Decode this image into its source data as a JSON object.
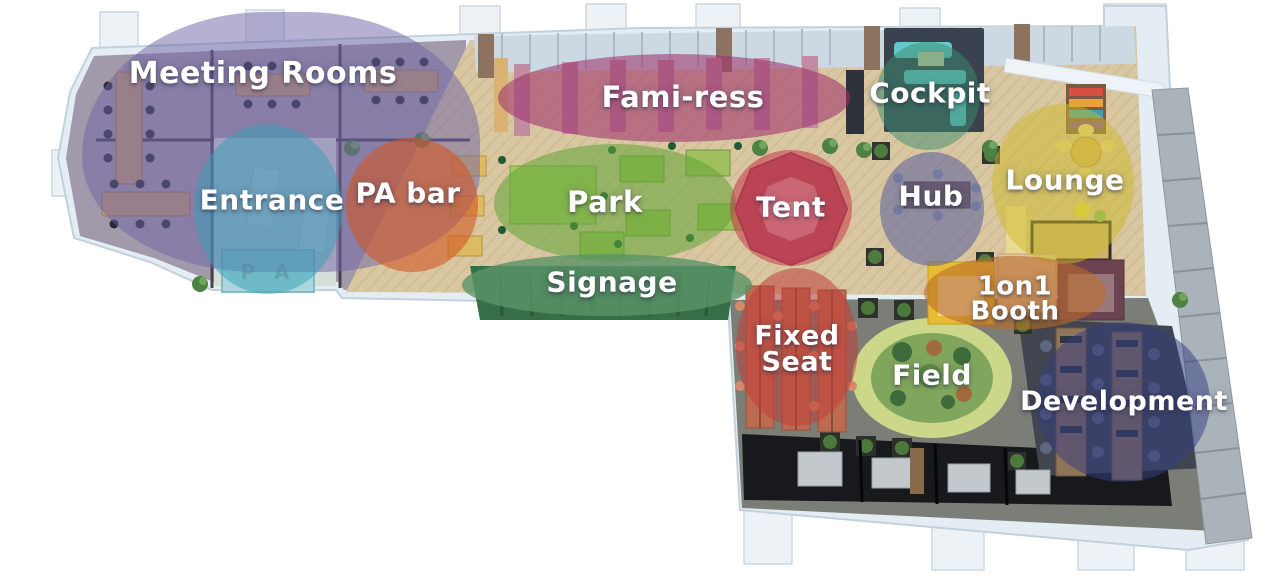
{
  "floorplan": {
    "entrance_mat_text": "P A",
    "palette": {
      "wall": "#e4edf3",
      "wood_floor": "#d9c7a1",
      "meeting_floor": "#a29aab",
      "lower_wing_floor": "#7b7e76",
      "dark_rooms": "#17191d",
      "field_outer": "#cdd789",
      "field_inner": "#80a65d",
      "right_wall": "#aab3ba"
    },
    "zones": [
      {
        "id": "meeting-rooms",
        "label": "Meeting Rooms",
        "x": 82,
        "y": 12,
        "w": 398,
        "h": 260,
        "radius": "48% 46% 42% 46% / 58% 52% 40% 46%",
        "color": "rgba(110,98,165,0.50)",
        "dx": -18,
        "dy": -68,
        "font": 30
      },
      {
        "id": "fami-ress",
        "label": "Fami-ress",
        "x": 498,
        "y": 54,
        "w": 352,
        "h": 88,
        "radius": "50%",
        "color": "rgba(158,52,110,0.58)",
        "dx": 9,
        "dy": 0,
        "font": 29
      },
      {
        "id": "cockpit",
        "label": "Cockpit",
        "x": 876,
        "y": 42,
        "w": 104,
        "h": 108,
        "radius": "50%",
        "color": "rgba(60,140,108,0.50)",
        "dx": 2,
        "dy": -2,
        "font": 28
      },
      {
        "id": "entrance",
        "label": "Entrance",
        "x": 194,
        "y": 124,
        "w": 148,
        "h": 170,
        "radius": "50%",
        "color": "rgba(60,160,182,0.52)",
        "dx": 4,
        "dy": -8,
        "font": 28
      },
      {
        "id": "pa-bar",
        "label": "PA bar",
        "x": 346,
        "y": 138,
        "w": 132,
        "h": 134,
        "radius": "50%",
        "color": "rgba(210,86,36,0.60)",
        "dx": -4,
        "dy": -11,
        "font": 28
      },
      {
        "id": "park",
        "label": "Park",
        "x": 494,
        "y": 144,
        "w": 242,
        "h": 118,
        "radius": "50%",
        "color": "rgba(96,164,54,0.55)",
        "dx": -10,
        "dy": 0,
        "font": 29
      },
      {
        "id": "tent",
        "label": "Tent",
        "x": 730,
        "y": 150,
        "w": 122,
        "h": 116,
        "radius": "50%",
        "color": "rgba(198,54,74,0.55)",
        "dx": 0,
        "dy": 0,
        "font": 28
      },
      {
        "id": "hub",
        "label": "Hub",
        "x": 880,
        "y": 152,
        "w": 104,
        "h": 114,
        "radius": "50%",
        "color": "rgba(86,92,156,0.55)",
        "dx": -1,
        "dy": -12,
        "font": 28
      },
      {
        "id": "lounge",
        "label": "Lounge",
        "x": 992,
        "y": 104,
        "w": 142,
        "h": 160,
        "radius": "50%",
        "color": "rgba(206,186,42,0.50)",
        "dx": 2,
        "dy": -3,
        "font": 28
      },
      {
        "id": "signage",
        "label": "Signage",
        "x": 462,
        "y": 254,
        "w": 290,
        "h": 62,
        "radius": "50%",
        "color": "rgba(90,148,102,0.80)",
        "dx": 5,
        "dy": -2,
        "font": 28
      },
      {
        "id": "fixed-seat",
        "label": "Fixed Seat",
        "lines": [
          "Fixed",
          "Seat"
        ],
        "x": 736,
        "y": 268,
        "w": 122,
        "h": 158,
        "radius": "50%",
        "color": "rgba(192,62,58,0.55)",
        "dx": 0,
        "dy": 2,
        "font": 27
      },
      {
        "id": "1on1-booth",
        "label": "1on1 Booth",
        "lines": [
          "1on1",
          "Booth"
        ],
        "x": 924,
        "y": 256,
        "w": 182,
        "h": 74,
        "radius": "50%",
        "color": "rgba(186,108,44,0.60)",
        "dx": 0,
        "dy": 6,
        "font": 26
      },
      {
        "id": "field",
        "label": "Field",
        "x": 862,
        "y": 318,
        "w": 140,
        "h": 116,
        "radius": "50%",
        "color": "rgba(0,0,0,0)",
        "dx": 0,
        "dy": 0,
        "font": 28
      },
      {
        "id": "development",
        "label": "Development",
        "x": 1036,
        "y": 322,
        "w": 174,
        "h": 160,
        "radius": "50%",
        "color": "rgba(54,62,130,0.52)",
        "dx": 1,
        "dy": 0,
        "font": 27
      }
    ]
  }
}
